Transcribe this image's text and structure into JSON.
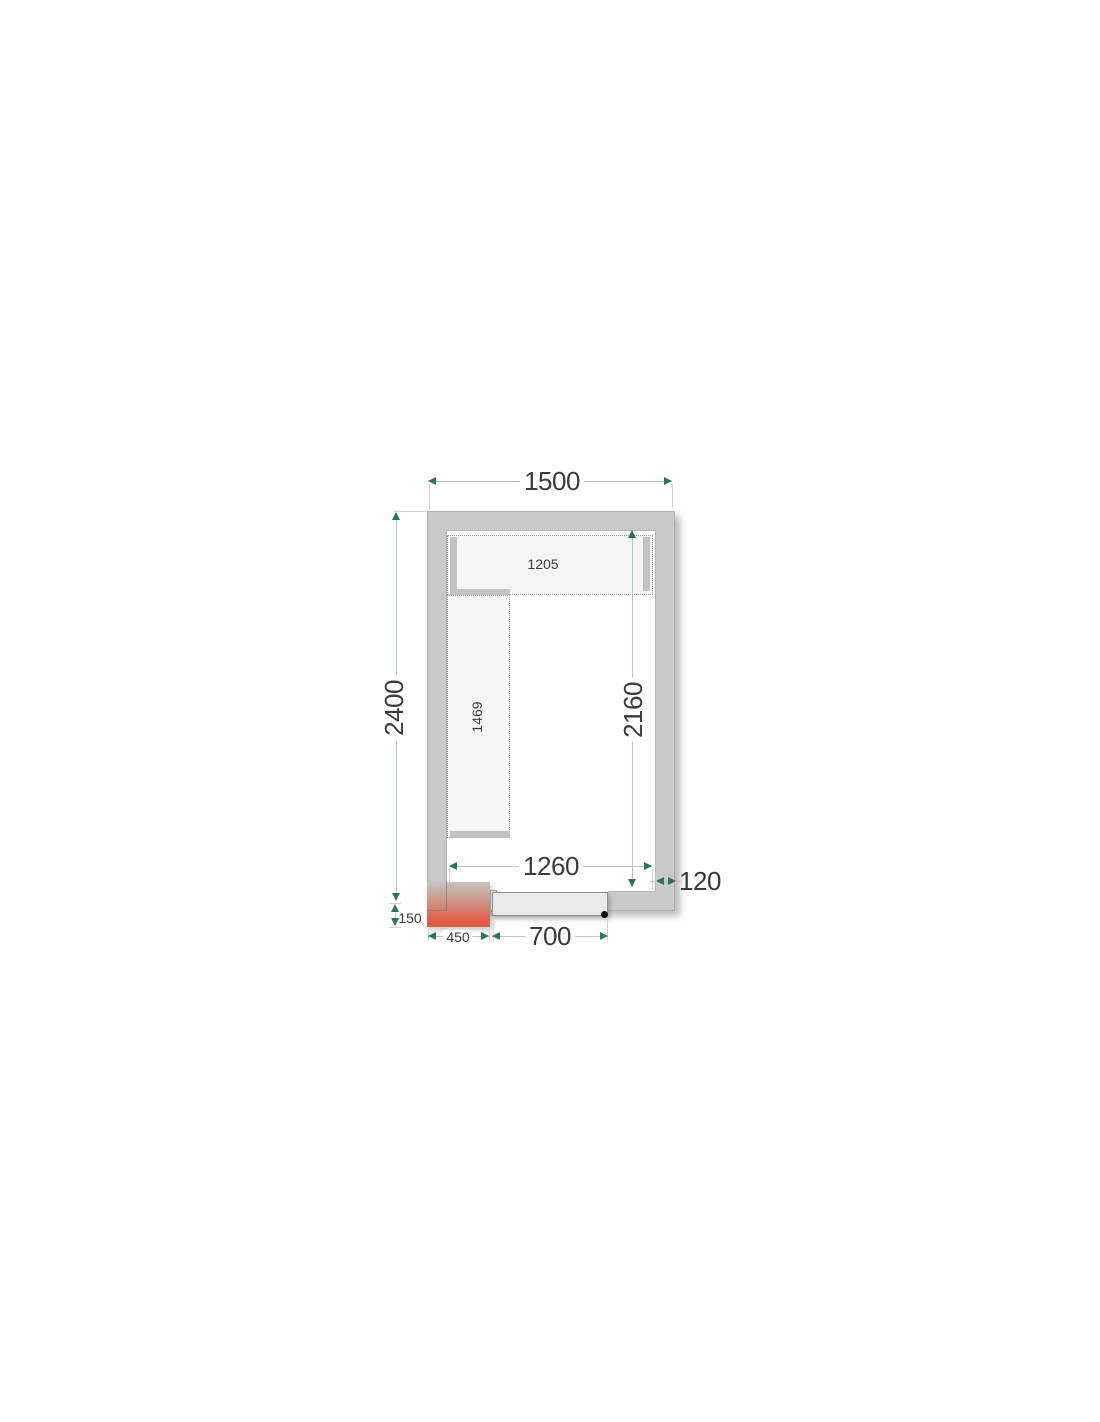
{
  "diagram": {
    "title": "Cold room floor plan drawing",
    "labels": {
      "outer_width_mm": "1500",
      "outer_depth_mm": "2400",
      "inner_depth_mm": "2160",
      "inner_width_mm": "1260",
      "wall_thickness_mm": "120",
      "top_shelf_length_mm": "1205",
      "left_shelf_length_mm": "1469",
      "door_width_mm": "700",
      "unit_width_mm": "450",
      "unit_height_mm": "150"
    },
    "colors": {
      "wall": "#c9c9c8",
      "wall-border": "#aeaeae",
      "inner-border": "#b5b5b5",
      "shelf": "#f5f5f4",
      "shelf-border": "#9e9e9e",
      "support": "#c2c2c1",
      "door": "#e9e9e9",
      "door-border": "#8f8f8f",
      "dim-line": "#b9c6bf",
      "dim-ext": "#ccd5cf",
      "arrow": "#2e7258",
      "text": "#3a3a3a",
      "handle": "#000000",
      "unit-grad-top": "#c4c4c2",
      "unit-grad-mid": "#cd9384",
      "unit-grad-low": "#df614b",
      "unit-grad-bottom": "#dc5942"
    }
  }
}
